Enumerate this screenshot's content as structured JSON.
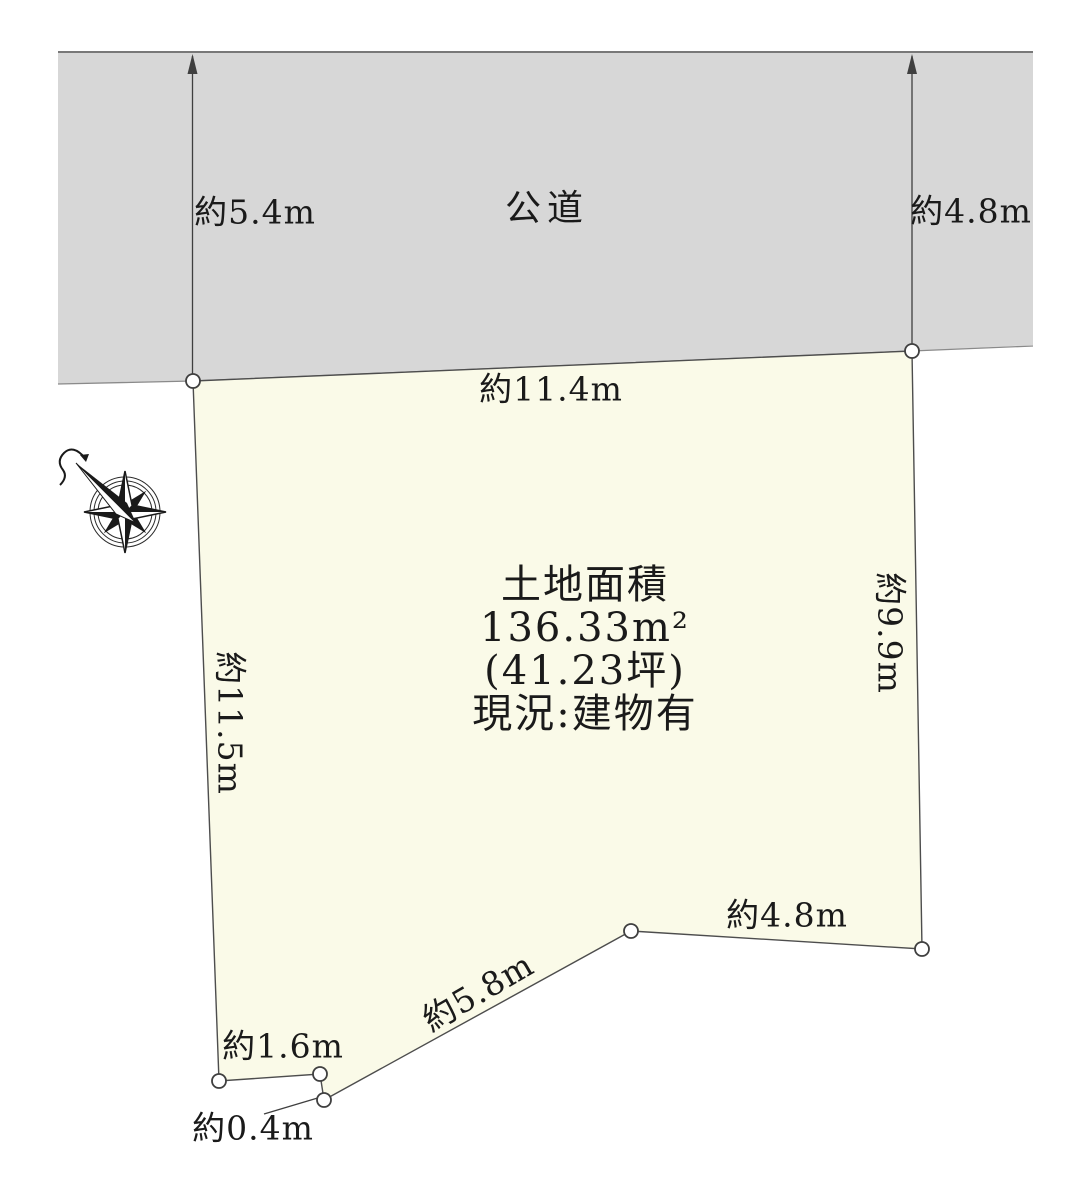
{
  "site_plan": {
    "road": {
      "name": "公道",
      "left_width": "約5.4m",
      "right_width": "約4.8m"
    },
    "parcel": {
      "area_title": "土地面積",
      "area_m2": "136.33m²",
      "area_tsubo": "(41.23坪)",
      "status": "現況:建物有",
      "frontage_top": "約11.4m",
      "edge_right": "約9.9m",
      "edge_left": "約11.5m",
      "edge_bottom_right": "約4.8m",
      "edge_bottom_diagonal": "約5.8m",
      "edge_bottom_left": "約1.6m",
      "edge_bottom_notch": "約0.4m"
    },
    "colors": {
      "road_fill": "#d7d7d7",
      "parcel_fill": "#fafae8",
      "line": "#3f3f3f",
      "text": "#1a1a1a"
    },
    "icons": {
      "compass": "compass-rose-north"
    }
  }
}
